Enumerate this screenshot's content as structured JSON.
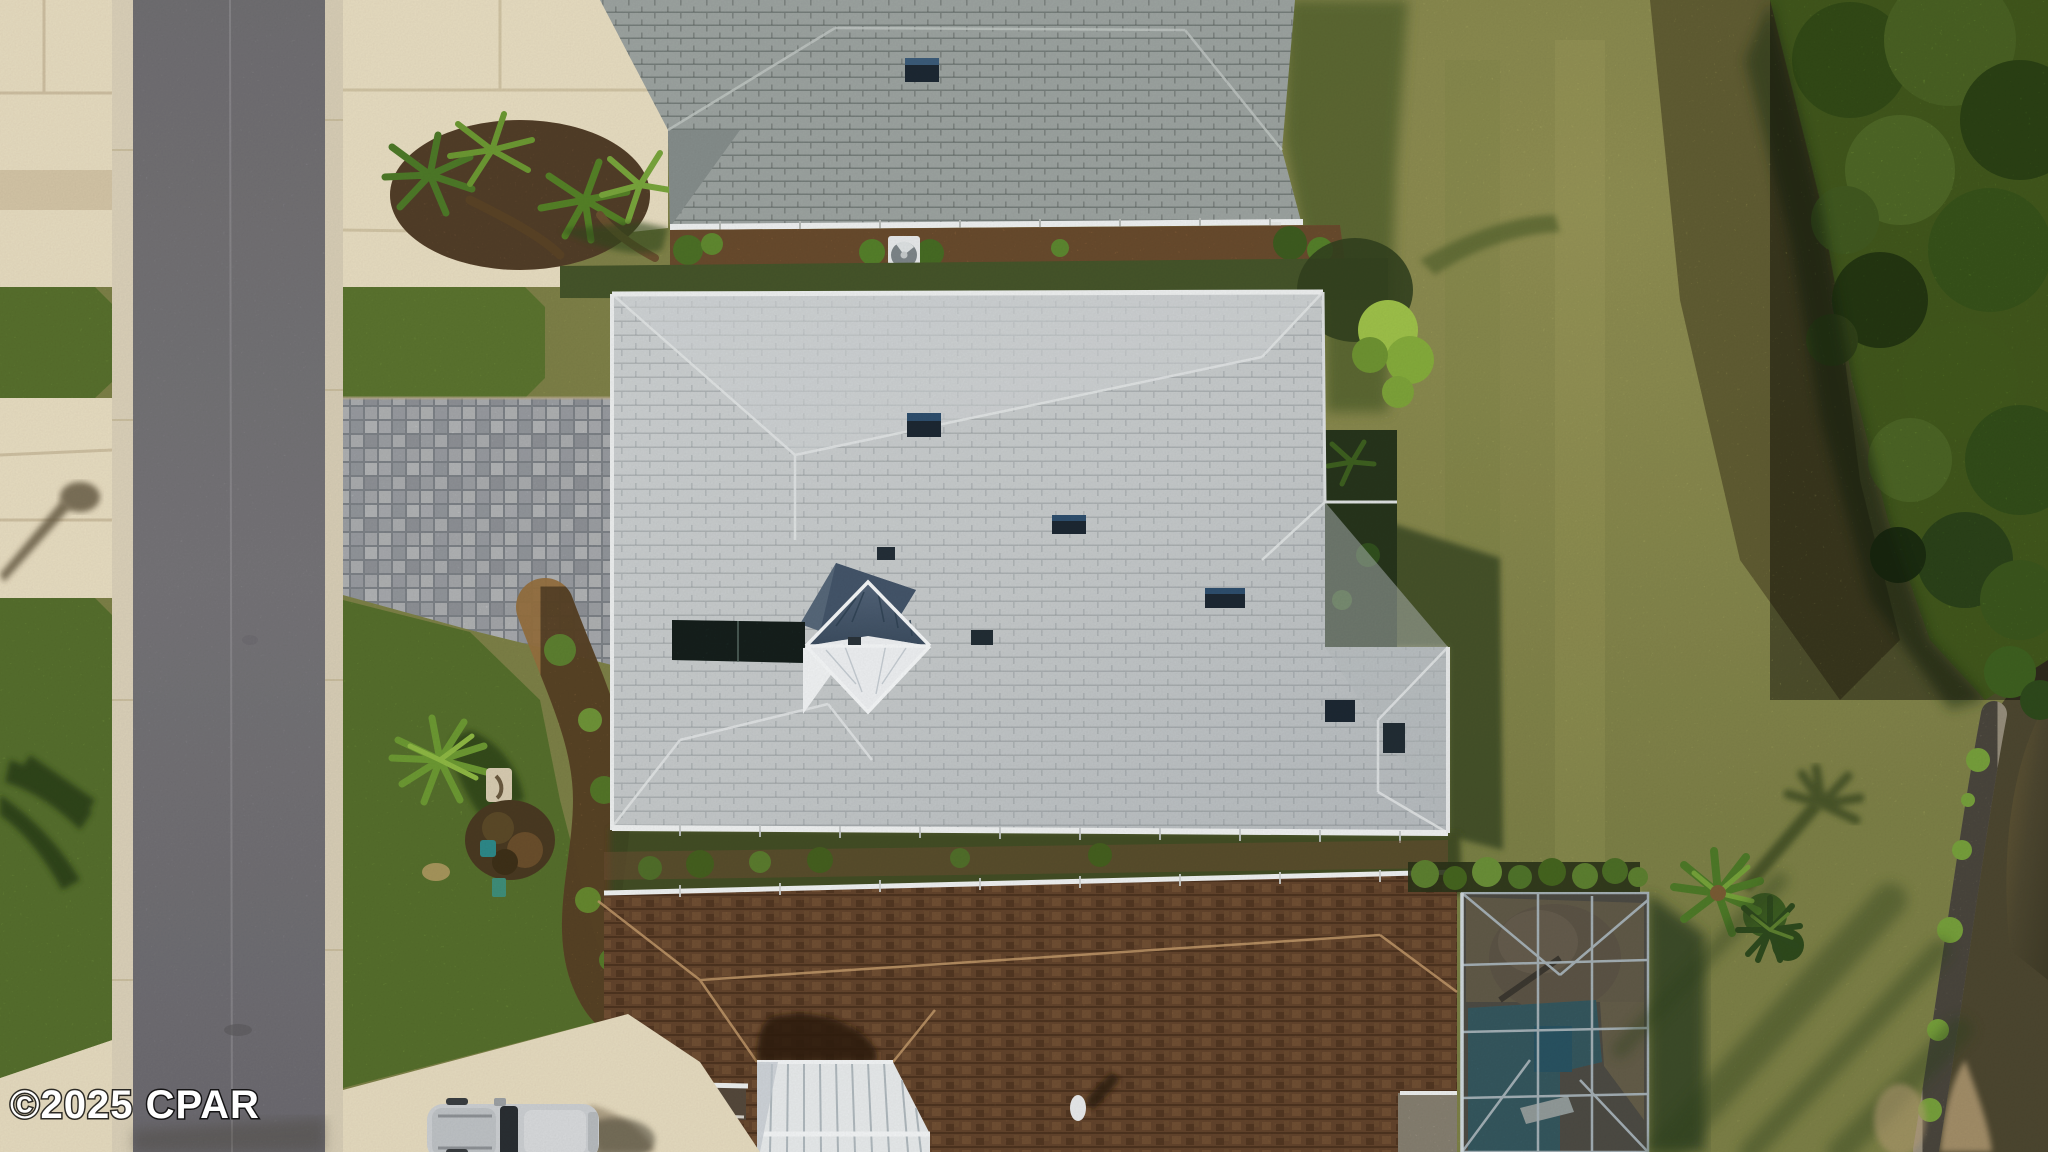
{
  "image": {
    "kind": "aerial-drone-photograph",
    "description": "Top-down aerial photo of a coastal residential neighborhood: a gray asphalt street with concrete curbs and driveways on the left, a large light-gray shingled house with a white metal cupola in the center fronted by a gray brick-paver driveway, a darker gray roof of a neighboring house at top, a brown shingled house with a white standing-seam metal gable and a screened pool enclosure at bottom, a wide olive lawn with long palm-tree shadows to the right, a dense tree line along the right edge, and a rocky pond shoreline in the bottom-right corner. A silver SUV is parked at the bottom driveway.",
    "width": 2048,
    "height": 1152
  },
  "watermark": {
    "text": "©2025 CPAR"
  },
  "palette": {
    "lawn": "#a2a65c",
    "lawn_light": "#b3b268",
    "grass_vivid": "#7fa242",
    "grass_shadow": "#46552a",
    "concrete": "#e8ddc1",
    "curb": "#dcd2ba",
    "road": "#8c8a8e",
    "pavers": "#c3c6ca",
    "mulch": "#96703f",
    "roof_top_house": "#9da4a1",
    "roof_main": "#c6cacb",
    "roof_brown": "#855c3c",
    "metal_white": "#e9eced",
    "cupola_dark": "#4a5b6e",
    "cupola_white": "#eff1f3",
    "atrium_glass": "#2b403a",
    "gutter_white": "#f0f2f2",
    "pool_water": "#5fa9bf",
    "pool_deck": "#8d7a5e",
    "screen_mesh": "#232e2b",
    "screen_frame": "#a8b4ba",
    "tree_canopy": "#6d9230",
    "tree_dark": "#2e4a1c",
    "brush_strip": "#98914f",
    "pond_water": "#4d4730",
    "shore_rock": "#968e7c",
    "suv_body": "#cdd0d3",
    "vent_dark": "#1d2833"
  },
  "scene": {
    "objects": [
      {
        "name": "street",
        "label": "asphalt street running vertically on the left"
      },
      {
        "name": "left-driveways",
        "label": "beige concrete driveways and sidewalk strips"
      },
      {
        "name": "street-lamp-shadow",
        "label": "street light shadow on concrete"
      },
      {
        "name": "paver-driveway",
        "label": "gray brick paver driveway of center house"
      },
      {
        "name": "top-house",
        "label": "neighboring house with gray shingle roof (top edge)"
      },
      {
        "name": "ac-unit",
        "label": "white air-conditioner unit with round fan"
      },
      {
        "name": "main-house",
        "label": "large light-gray hip roof with white metal cupola"
      },
      {
        "name": "cupola",
        "label": "standing-seam metal cupola, dark and white faces"
      },
      {
        "name": "roof-vents",
        "label": "dark rooftop vents"
      },
      {
        "name": "bottom-house",
        "label": "brown shingled house with white metal gable"
      },
      {
        "name": "pool-enclosure",
        "label": "screened pool cage with blue pool and tan deck"
      },
      {
        "name": "palm-trees",
        "label": "palms and palmettos in landscape beds"
      },
      {
        "name": "right-lawn",
        "label": "wide olive lawn with long shadows"
      },
      {
        "name": "tree-line",
        "label": "dense trees along right edge"
      },
      {
        "name": "pond-shore",
        "label": "rocky pond shoreline, bottom-right corner"
      },
      {
        "name": "suv",
        "label": "silver SUV parked on bottom driveway"
      }
    ]
  }
}
